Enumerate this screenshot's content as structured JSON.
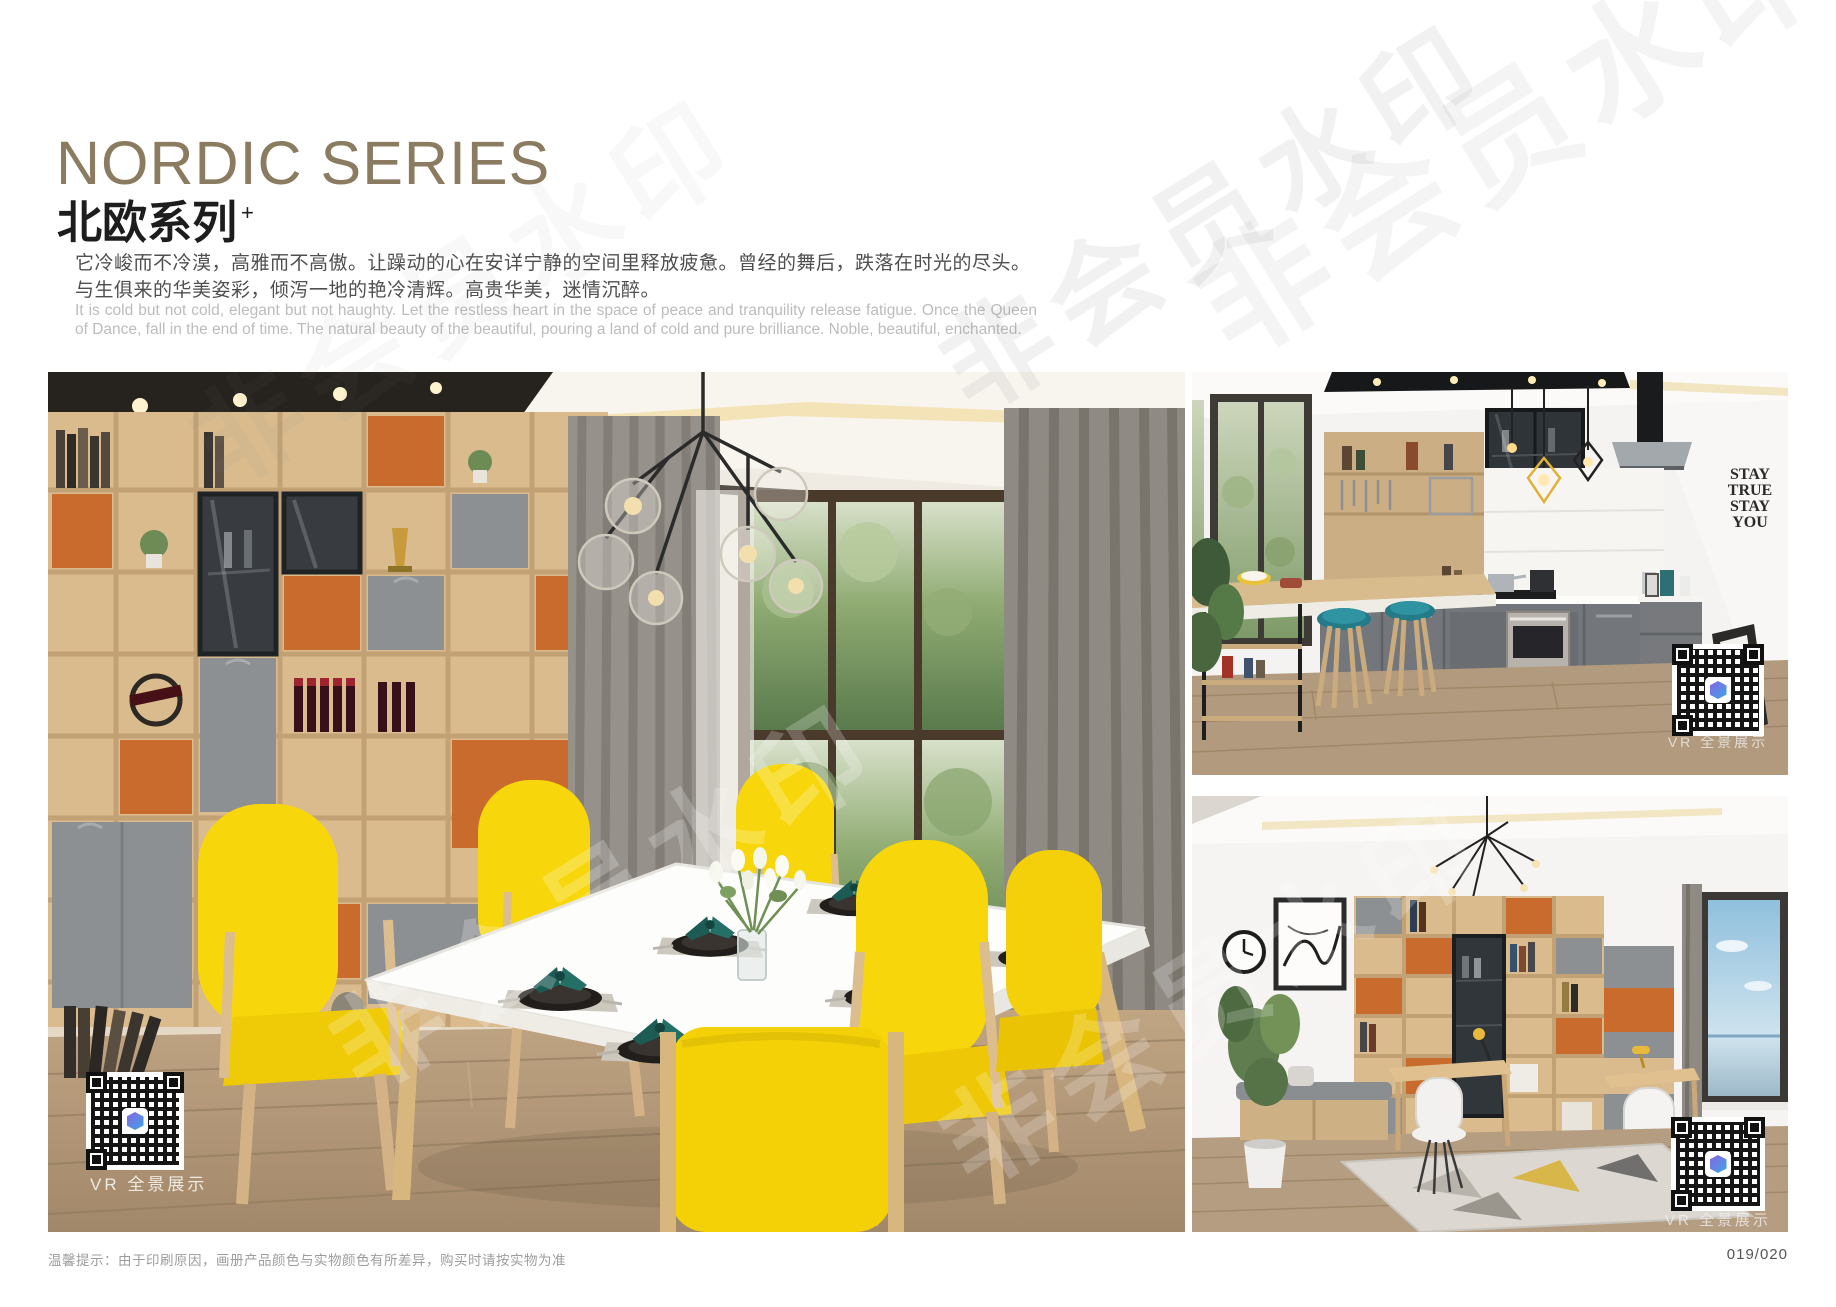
{
  "header": {
    "title_en": "NORDIC SERIES",
    "title_zh": "北欧系列",
    "title_superscript": "+",
    "paragraph_zh": "它冷峻而不冷漠，高雅而不高傲。让躁动的心在安详宁静的空间里释放疲惫。曾经的舞后，跌落在时光的尽头。与生俱来的华美姿彩，倾泻一地的艳冷清辉。高贵华美，迷情沉醉。",
    "paragraph_en": "It is cold but not cold, elegant but not haughty. Let the restless heart in the space of peace and tranquility release fatigue. Once the Queen of Dance, fall in the end of time. The natural beauty of the beautiful, pouring a land of cold and pure brilliance. Noble, beautiful, enchanted."
  },
  "photos": {
    "dining": {
      "alt": "Nordic dining room with oak display shelving, orange niches, grey doors, yellow dining chairs, white table and garden window",
      "vr_label": "VR 全景展示"
    },
    "kitchen": {
      "alt": "Open kitchen with grey base cabinets, oak breakfast bar, teal bar stools and steel hood",
      "vr_label": "VR 全景展示",
      "wall_decal": [
        "STAY",
        "TRUE",
        "STAY",
        "YOU"
      ]
    },
    "study": {
      "alt": "Study with oak bookshelf, glass display cabinet, desks, white chairs, window seat and geometric rug",
      "vr_label": "VR 全景展示"
    }
  },
  "footer": {
    "tip": "温馨提示：由于印刷原因，画册产品颜色与实物颜色有所差异，购买时请按实物为准",
    "page_number": "019/020"
  },
  "watermark": {
    "text": "非会员水印"
  },
  "colors": {
    "title_bronze": "#8b7c61",
    "accent_yellow": "#f7d50a",
    "accent_orange": "#c96b2c",
    "cabinet_grey": "#8d9093",
    "oak_wood": "#d9bb8e",
    "napkin_teal": "#1c5a55"
  }
}
